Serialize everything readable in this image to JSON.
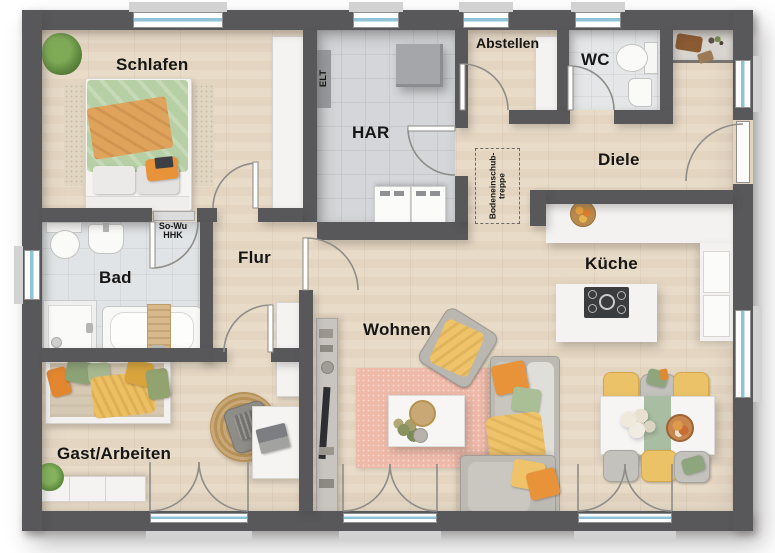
{
  "plan": {
    "rooms": {
      "schlafen": {
        "label": "Schlafen"
      },
      "har": {
        "label": "HAR"
      },
      "abstellen": {
        "label": "Abstellen"
      },
      "wc": {
        "label": "WC"
      },
      "diele": {
        "label": "Diele"
      },
      "bad": {
        "label": "Bad"
      },
      "flur": {
        "label": "Flur"
      },
      "kueche": {
        "label": "Küche"
      },
      "wohnen": {
        "label": "Wohnen"
      },
      "gast": {
        "label": "Gast/Arbeiten"
      }
    },
    "annotations": {
      "elt": "ELT",
      "sowu1": "So-Wu",
      "sowu2": "HHK",
      "attic1": "Bodeneinschub-",
      "attic2": "treppe"
    },
    "colors": {
      "wall": "#58585b",
      "wood_floor": "#e7d9c5",
      "tile_bad": "#e1e4e6",
      "tile_wc": "#e4e6e8",
      "tile_har": "#d4d6d9",
      "window_glass": "#8fc3da",
      "sill": "#d2d2d2",
      "furniture_white": "#f4f3f1",
      "sofa_gray": "#c0bdb7",
      "accent_orange": "#e28a33",
      "accent_yellow": "#eabf5f",
      "accent_green": "#9fb489",
      "rug_pink": "#eeb9a8",
      "rug_jute": "#c9a878",
      "cooktop_black": "#3b3c3e",
      "label_color": "#161616"
    }
  }
}
